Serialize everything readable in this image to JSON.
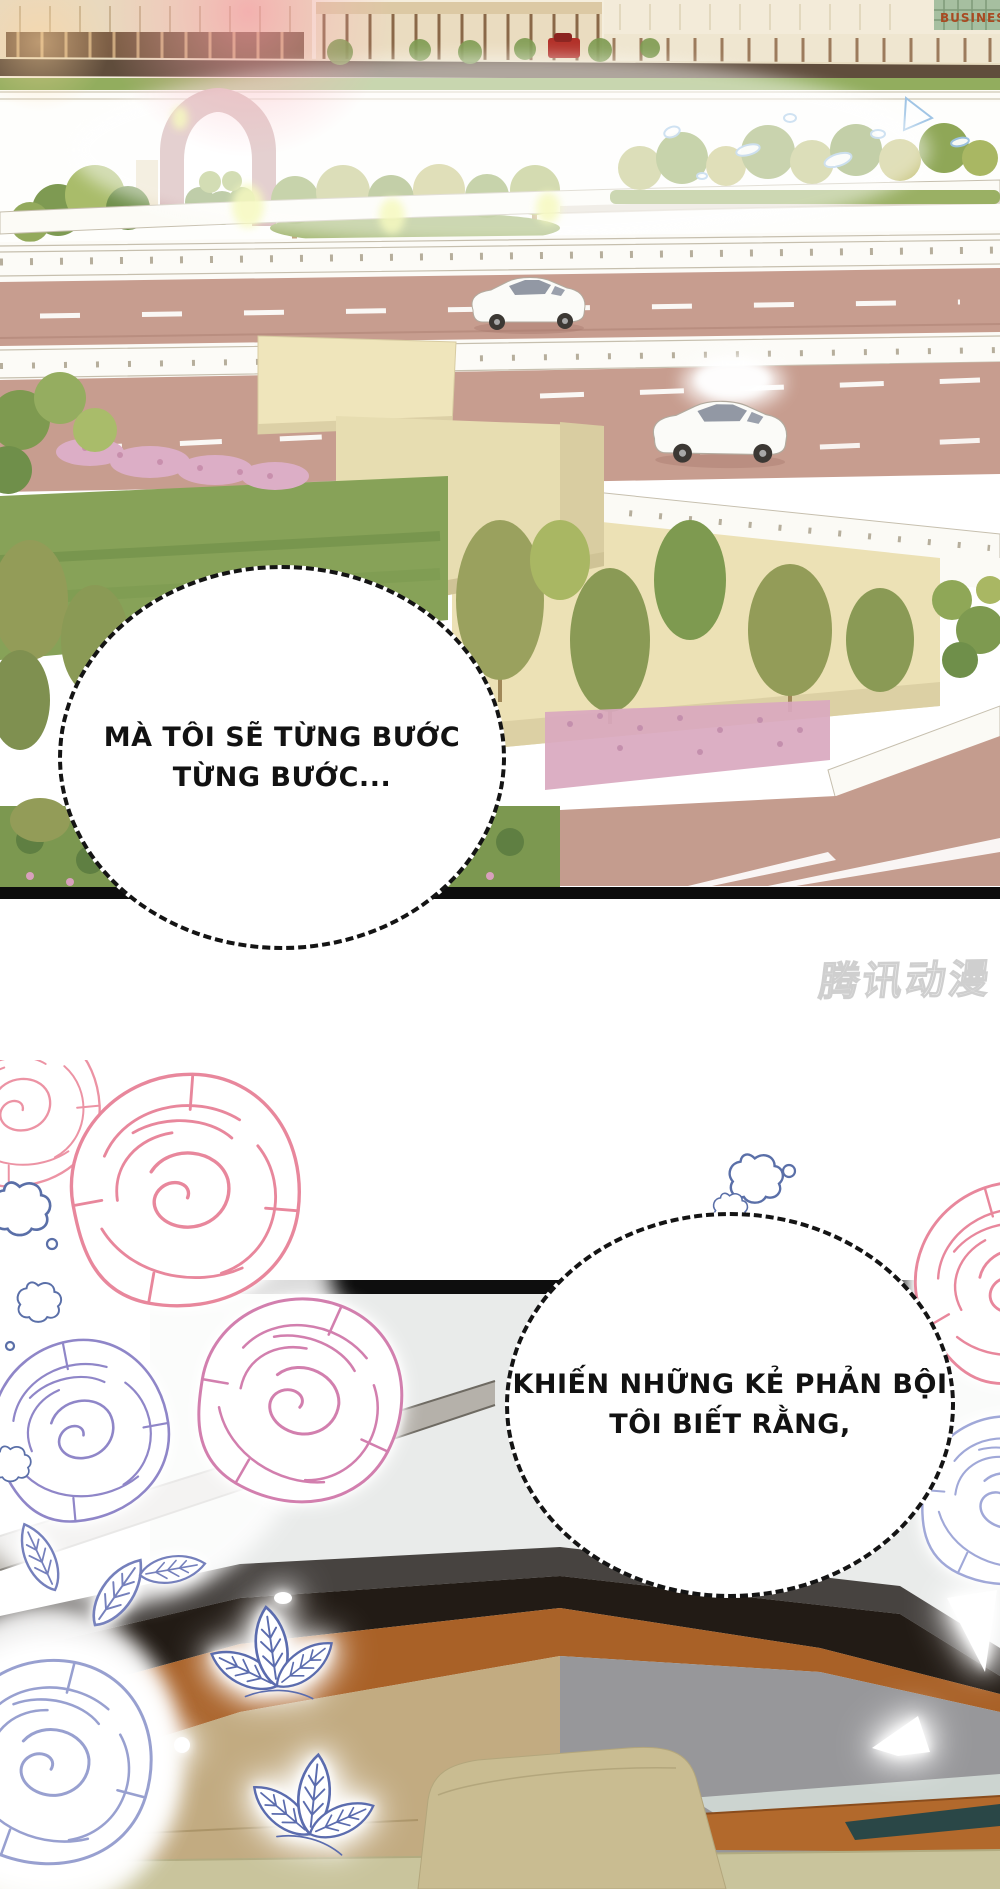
{
  "page": {
    "width": 1000,
    "height": 1889,
    "background": "#ffffff"
  },
  "panel1": {
    "description": "overexposed 3D-render cityscape with elevated highways, trees and a pedestrian arch",
    "business_sign": "BUSINESS",
    "bubble": {
      "lines": [
        "MÀ TÔI SẼ TỪNG BƯỚC",
        "TỪNG BƯỚC..."
      ]
    },
    "cars": [
      {
        "name": "red-car-street"
      },
      {
        "name": "white-sedan-upper-road"
      },
      {
        "name": "white-sedan-lower-road"
      }
    ]
  },
  "watermark": {
    "text": "腾讯动漫"
  },
  "panel2": {
    "description": "line-art roses and glowing leaves over a dark car-interior scene",
    "bubble": {
      "lines": [
        "KHIẾN NHỮNG KẺ PHẢN BỘI",
        "TÔI BIẾT RẰNG,"
      ]
    }
  },
  "colors": {
    "road_mauve": "#c79d8f",
    "guardrail_white": "#fcfbf7",
    "bridge_beige": "#ece1b5",
    "grass_green": "#87a258",
    "pink_shrub": "#dcaec6",
    "arch_mauve": "#c9a1a1",
    "panel_border_black": "#0d0d0d",
    "interior_gray": "#e9ebea",
    "band_graphite": "#474340",
    "band_black": "#221b15",
    "band_sienna": "#a96127",
    "band_gray": "#97979a",
    "seat_tan": "#c9bc91",
    "rose_pink": "#e8879c",
    "rose_purple": "#8f86c8",
    "leaf_blue": "#5b6cae",
    "droplet_blue": "#9cc2e4"
  }
}
